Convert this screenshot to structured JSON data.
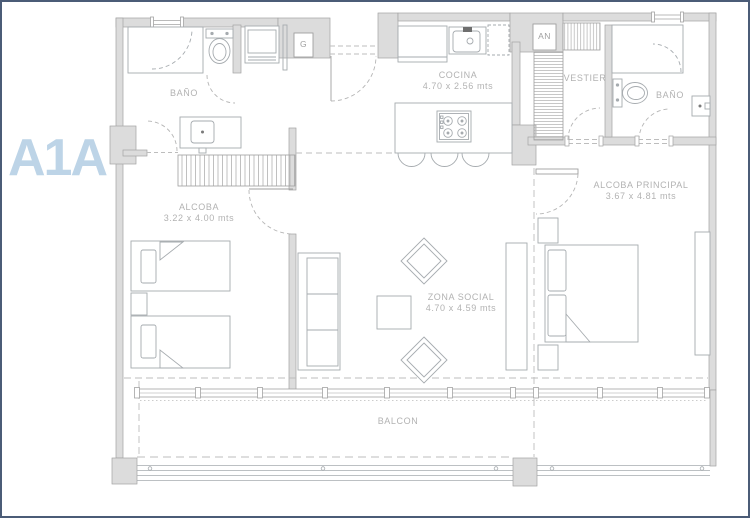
{
  "unit": {
    "code": "A1A"
  },
  "markers": {
    "gas_meter": "G",
    "shaft": "AN"
  },
  "rooms": {
    "bathroom_left": {
      "name": "BAÑO"
    },
    "kitchen": {
      "name": "COCINA",
      "dims": "4.70 x 2.56 mts"
    },
    "walk_in_closet": {
      "name": "VESTIER"
    },
    "bathroom_right": {
      "name": "BAÑO"
    },
    "bedroom": {
      "name": "ALCOBA",
      "dims": "3.22 x 4.00 mts"
    },
    "master_bedroom": {
      "name": "ALCOBA PRINCIPAL",
      "dims": "3.67 x 4.81 mts"
    },
    "living_area": {
      "name": "ZONA SOCIAL",
      "dims": "4.70 x 4.59 mts"
    },
    "balcony": {
      "name": "BALCON"
    }
  },
  "colors": {
    "accent_blue": "#bdd4e7",
    "wall_fill": "#dcdcdc",
    "wall_stroke": "#a3a3a3",
    "line": "#a6abaf",
    "label": "#b2b2b2",
    "page_border": "#4b5c77"
  }
}
